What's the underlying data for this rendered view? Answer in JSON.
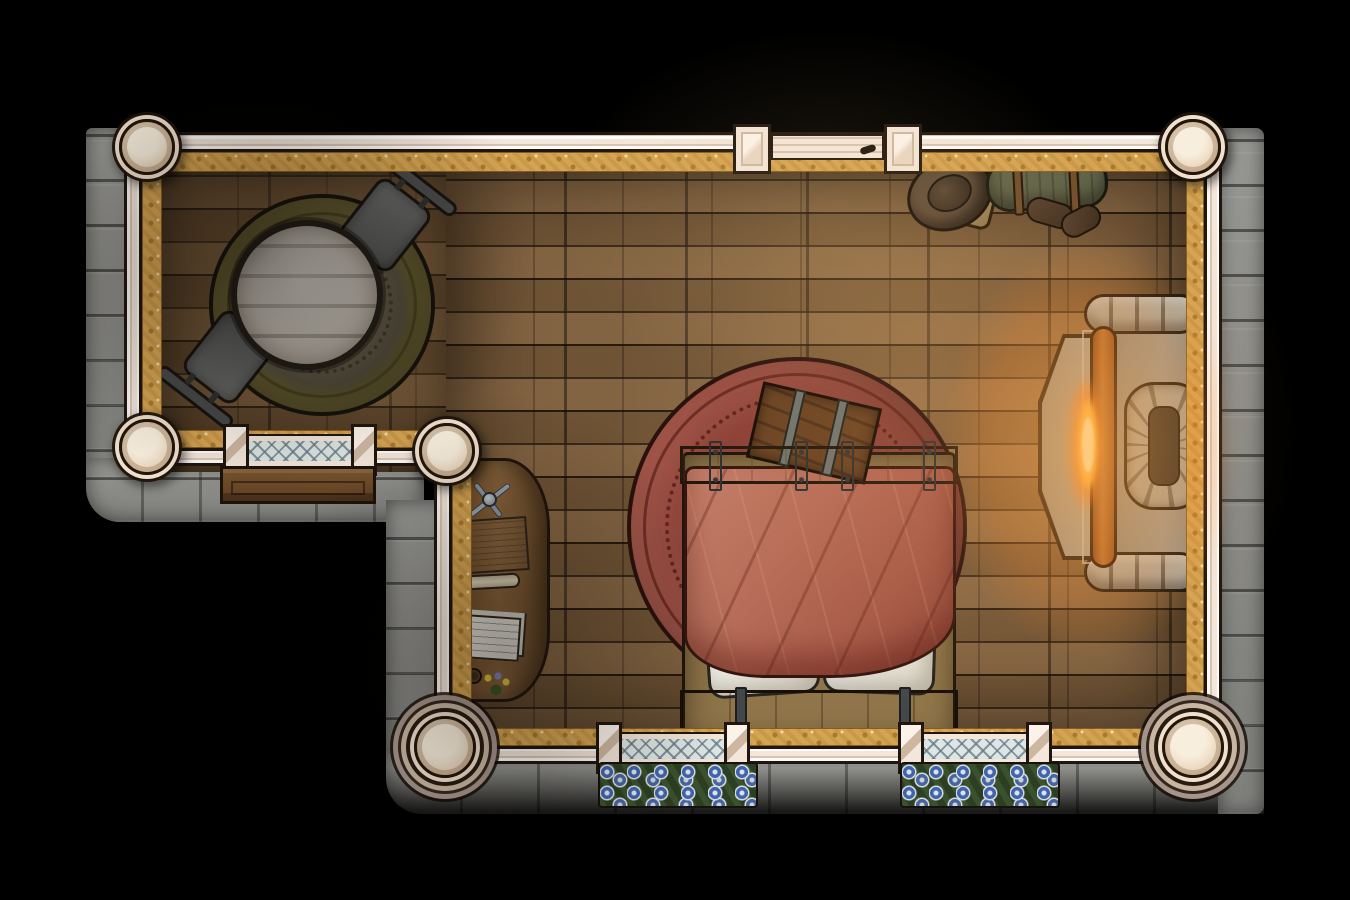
{
  "meta": {
    "scene": "top-down fantasy bedroom battlemap",
    "view": "orthographic top-down",
    "room_shape": "L-shaped single room with stone exterior and timber-plank floor"
  },
  "palette": {
    "void": "#000000",
    "stone": "#90908c",
    "plaster": "#f3e6da",
    "plaster_line": "#d9c4b2",
    "outline": "#20160e",
    "trim_gold": "#d5a452",
    "trim_gold_dark": "#a87a2e",
    "floor": "#7b5c3b",
    "glass": "#dde6e4",
    "table_wood": "#b3ada3",
    "blanket": "#b4685a",
    "fire_orange": "#ff9e2e",
    "fire_yellow": "#ffe27a",
    "flower_blue": "#3f63ae"
  },
  "structure": {
    "walls": [
      "top",
      "left-upper",
      "mid-left",
      "lower-left-vertical",
      "bottom",
      "right"
    ],
    "pillar_count": 6,
    "door": {
      "location": "top wall, center-right",
      "type": "plank door between two square posts"
    },
    "windows": [
      {
        "location": "mid-left wall",
        "style": "diamond-lattice",
        "exterior_feature": "wooden bench"
      },
      {
        "location": "bottom wall, left of bed",
        "style": "diamond-lattice",
        "exterior_feature": "blue flower box"
      },
      {
        "location": "bottom wall, right of bed",
        "style": "diamond-lattice",
        "exterior_feature": "blue flower box"
      }
    ]
  },
  "objects": [
    {
      "name": "round-rug-olive",
      "desc": "embroidered olive-gold circular rug"
    },
    {
      "name": "round-table",
      "desc": "grey plank round table"
    },
    {
      "name": "chair-northeast",
      "desc": "grey chair, rotated toward table"
    },
    {
      "name": "chair-southwest",
      "desc": "grey chair, rotated toward table"
    },
    {
      "name": "writing-desk",
      "desc": "curved wooden desk with open book, scroll, loose papers, dividers tool, mug and posy"
    },
    {
      "name": "round-rug-red",
      "desc": "large terracotta circular rug with ornate border"
    },
    {
      "name": "double-bed",
      "desc": "wooden double bed, red rumpled blanket, two white pillows"
    },
    {
      "name": "storage-chest",
      "desc": "strapped wooden chest at foot of bed, tilted"
    },
    {
      "name": "fireplace",
      "desc": "stone hearth on right wall with burning log, chimney ring and hexagonal hearthstone"
    },
    {
      "name": "traveler-hat",
      "desc": "wide-brim brown hat"
    },
    {
      "name": "satchel",
      "desc": "tan leather satchel"
    },
    {
      "name": "bedroll",
      "desc": "green strapped bedroll"
    },
    {
      "name": "boots",
      "desc": "pair of dark leather boots"
    }
  ]
}
